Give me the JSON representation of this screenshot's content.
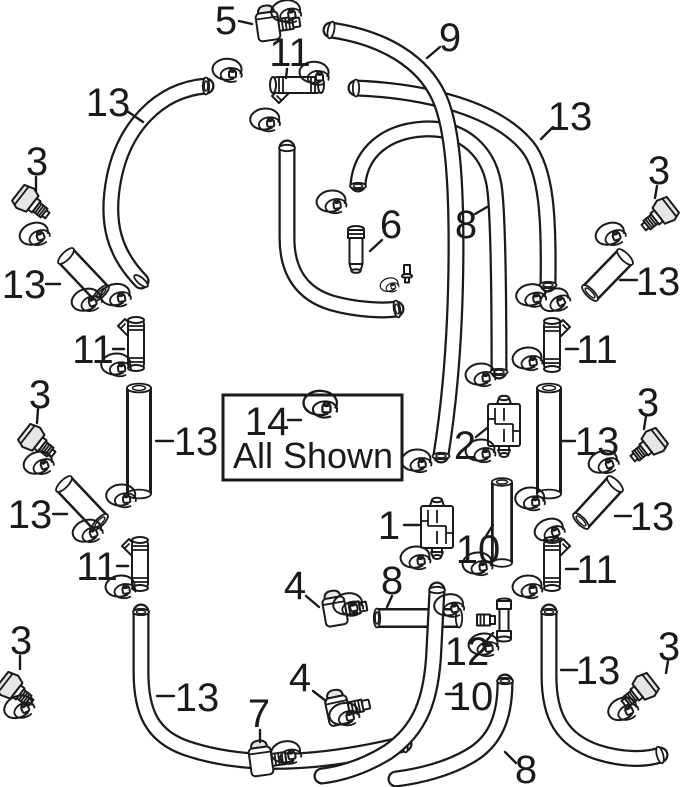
{
  "page": {
    "background": "#ffffff",
    "ink": "#1a1a1a",
    "shade": "#e6e6e6"
  },
  "legend_box": {
    "number": "14",
    "separator": "–",
    "label": "All Shown"
  },
  "callouts": [
    {
      "label": "5",
      "x": 226,
      "y": 20,
      "leader": [
        239,
        21,
        252,
        24
      ]
    },
    {
      "label": "11",
      "x": 290,
      "y": 52,
      "leader": [
        287,
        69,
        286,
        78
      ]
    },
    {
      "label": "9",
      "x": 450,
      "y": 37,
      "leader": [
        440,
        47,
        427,
        58
      ]
    },
    {
      "label": "13",
      "x": 108,
      "y": 102,
      "leader": [
        127,
        111,
        143,
        122
      ]
    },
    {
      "label": "13",
      "x": 570,
      "y": 116,
      "leader": [
        553,
        127,
        541,
        139
      ]
    },
    {
      "label": "3",
      "x": 37,
      "y": 161,
      "leader": [
        36,
        177,
        36,
        191
      ]
    },
    {
      "label": "13",
      "x": 24,
      "y": 284,
      "leader": [
        46,
        284,
        60,
        284
      ]
    },
    {
      "label": "11",
      "x": 93,
      "y": 349,
      "leader": [
        113,
        349,
        124,
        349
      ]
    },
    {
      "label": "13",
      "x": 196,
      "y": 441,
      "leader": [
        156,
        441,
        173,
        441
      ]
    },
    {
      "label": "3",
      "x": 40,
      "y": 394,
      "leader": [
        38,
        409,
        37,
        423
      ]
    },
    {
      "label": "13",
      "x": 30,
      "y": 514,
      "leader": [
        53,
        514,
        67,
        514
      ]
    },
    {
      "label": "11",
      "x": 97,
      "y": 566,
      "leader": [
        117,
        566,
        128,
        566
      ]
    },
    {
      "label": "3",
      "x": 21,
      "y": 640,
      "leader": [
        20,
        656,
        20,
        669
      ]
    },
    {
      "label": "13",
      "x": 197,
      "y": 697,
      "leader": [
        157,
        696,
        174,
        696
      ]
    },
    {
      "label": "7",
      "x": 259,
      "y": 713,
      "leader": [
        260,
        730,
        260,
        742
      ]
    },
    {
      "label": "4",
      "x": 295,
      "y": 585,
      "leader": [
        306,
        596,
        319,
        607
      ]
    },
    {
      "label": "4",
      "x": 300,
      "y": 677,
      "leader": [
        313,
        691,
        326,
        701
      ]
    },
    {
      "label": "8",
      "x": 392,
      "y": 580,
      "leader": [
        392,
        596,
        387,
        607
      ]
    },
    {
      "label": "12",
      "x": 467,
      "y": 651,
      "leader": [
        483,
        645,
        493,
        633
      ]
    },
    {
      "label": "10",
      "x": 478,
      "y": 549,
      "leader": [
        486,
        536,
        493,
        525
      ]
    },
    {
      "label": "10",
      "x": 471,
      "y": 696,
      "leader": [
        446,
        694,
        458,
        694
      ]
    },
    {
      "label": "8",
      "x": 526,
      "y": 769,
      "leader": [
        505,
        752,
        516,
        763
      ]
    },
    {
      "label": "1",
      "x": 389,
      "y": 525,
      "leader": [
        404,
        525,
        419,
        525
      ]
    },
    {
      "label": "2",
      "x": 465,
      "y": 445,
      "leader": [
        476,
        437,
        487,
        428
      ]
    },
    {
      "label": "6",
      "x": 391,
      "y": 224,
      "leader": [
        382,
        240,
        370,
        251
      ]
    },
    {
      "label": "8",
      "x": 466,
      "y": 224,
      "leader": [
        475,
        214,
        487,
        207
      ]
    },
    {
      "label": "3",
      "x": 659,
      "y": 170,
      "leader": [
        657,
        186,
        655,
        198
      ]
    },
    {
      "label": "13",
      "x": 658,
      "y": 281,
      "leader": [
        620,
        280,
        637,
        280
      ]
    },
    {
      "label": "11",
      "x": 597,
      "y": 349,
      "leader": [
        566,
        349,
        578,
        349
      ]
    },
    {
      "label": "13",
      "x": 597,
      "y": 441,
      "leader": [
        561,
        441,
        575,
        441
      ]
    },
    {
      "label": "3",
      "x": 648,
      "y": 402,
      "leader": [
        646,
        416,
        644,
        429
      ]
    },
    {
      "label": "13",
      "x": 652,
      "y": 516,
      "leader": [
        615,
        516,
        631,
        516
      ]
    },
    {
      "label": "11",
      "x": 597,
      "y": 569,
      "leader": [
        566,
        569,
        578,
        569
      ]
    },
    {
      "label": "3",
      "x": 669,
      "y": 646,
      "leader": [
        668,
        661,
        666,
        673
      ]
    },
    {
      "label": "13",
      "x": 598,
      "y": 670,
      "leader": [
        561,
        670,
        577,
        670
      ]
    }
  ]
}
